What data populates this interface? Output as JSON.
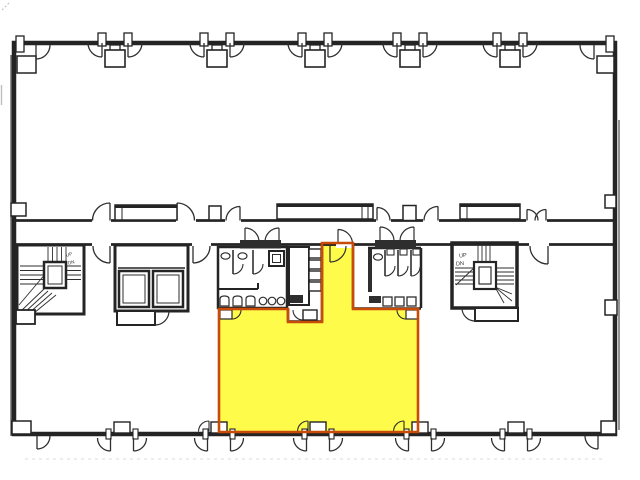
{
  "plan": {
    "paper": "#ffffff",
    "ink": "#242424",
    "highlight_unit": {
      "points": "219,309 288,309 288,322 322,322 322,243 353,243 353,309 418,309 418,432 219,432",
      "fill": "#fffb4a",
      "outline": "#c84b07"
    },
    "stairs": {
      "left": {
        "up_label": "UP",
        "dn_label": "DN"
      },
      "right": {
        "up_label": "UP",
        "dn_label": "DN"
      }
    }
  }
}
